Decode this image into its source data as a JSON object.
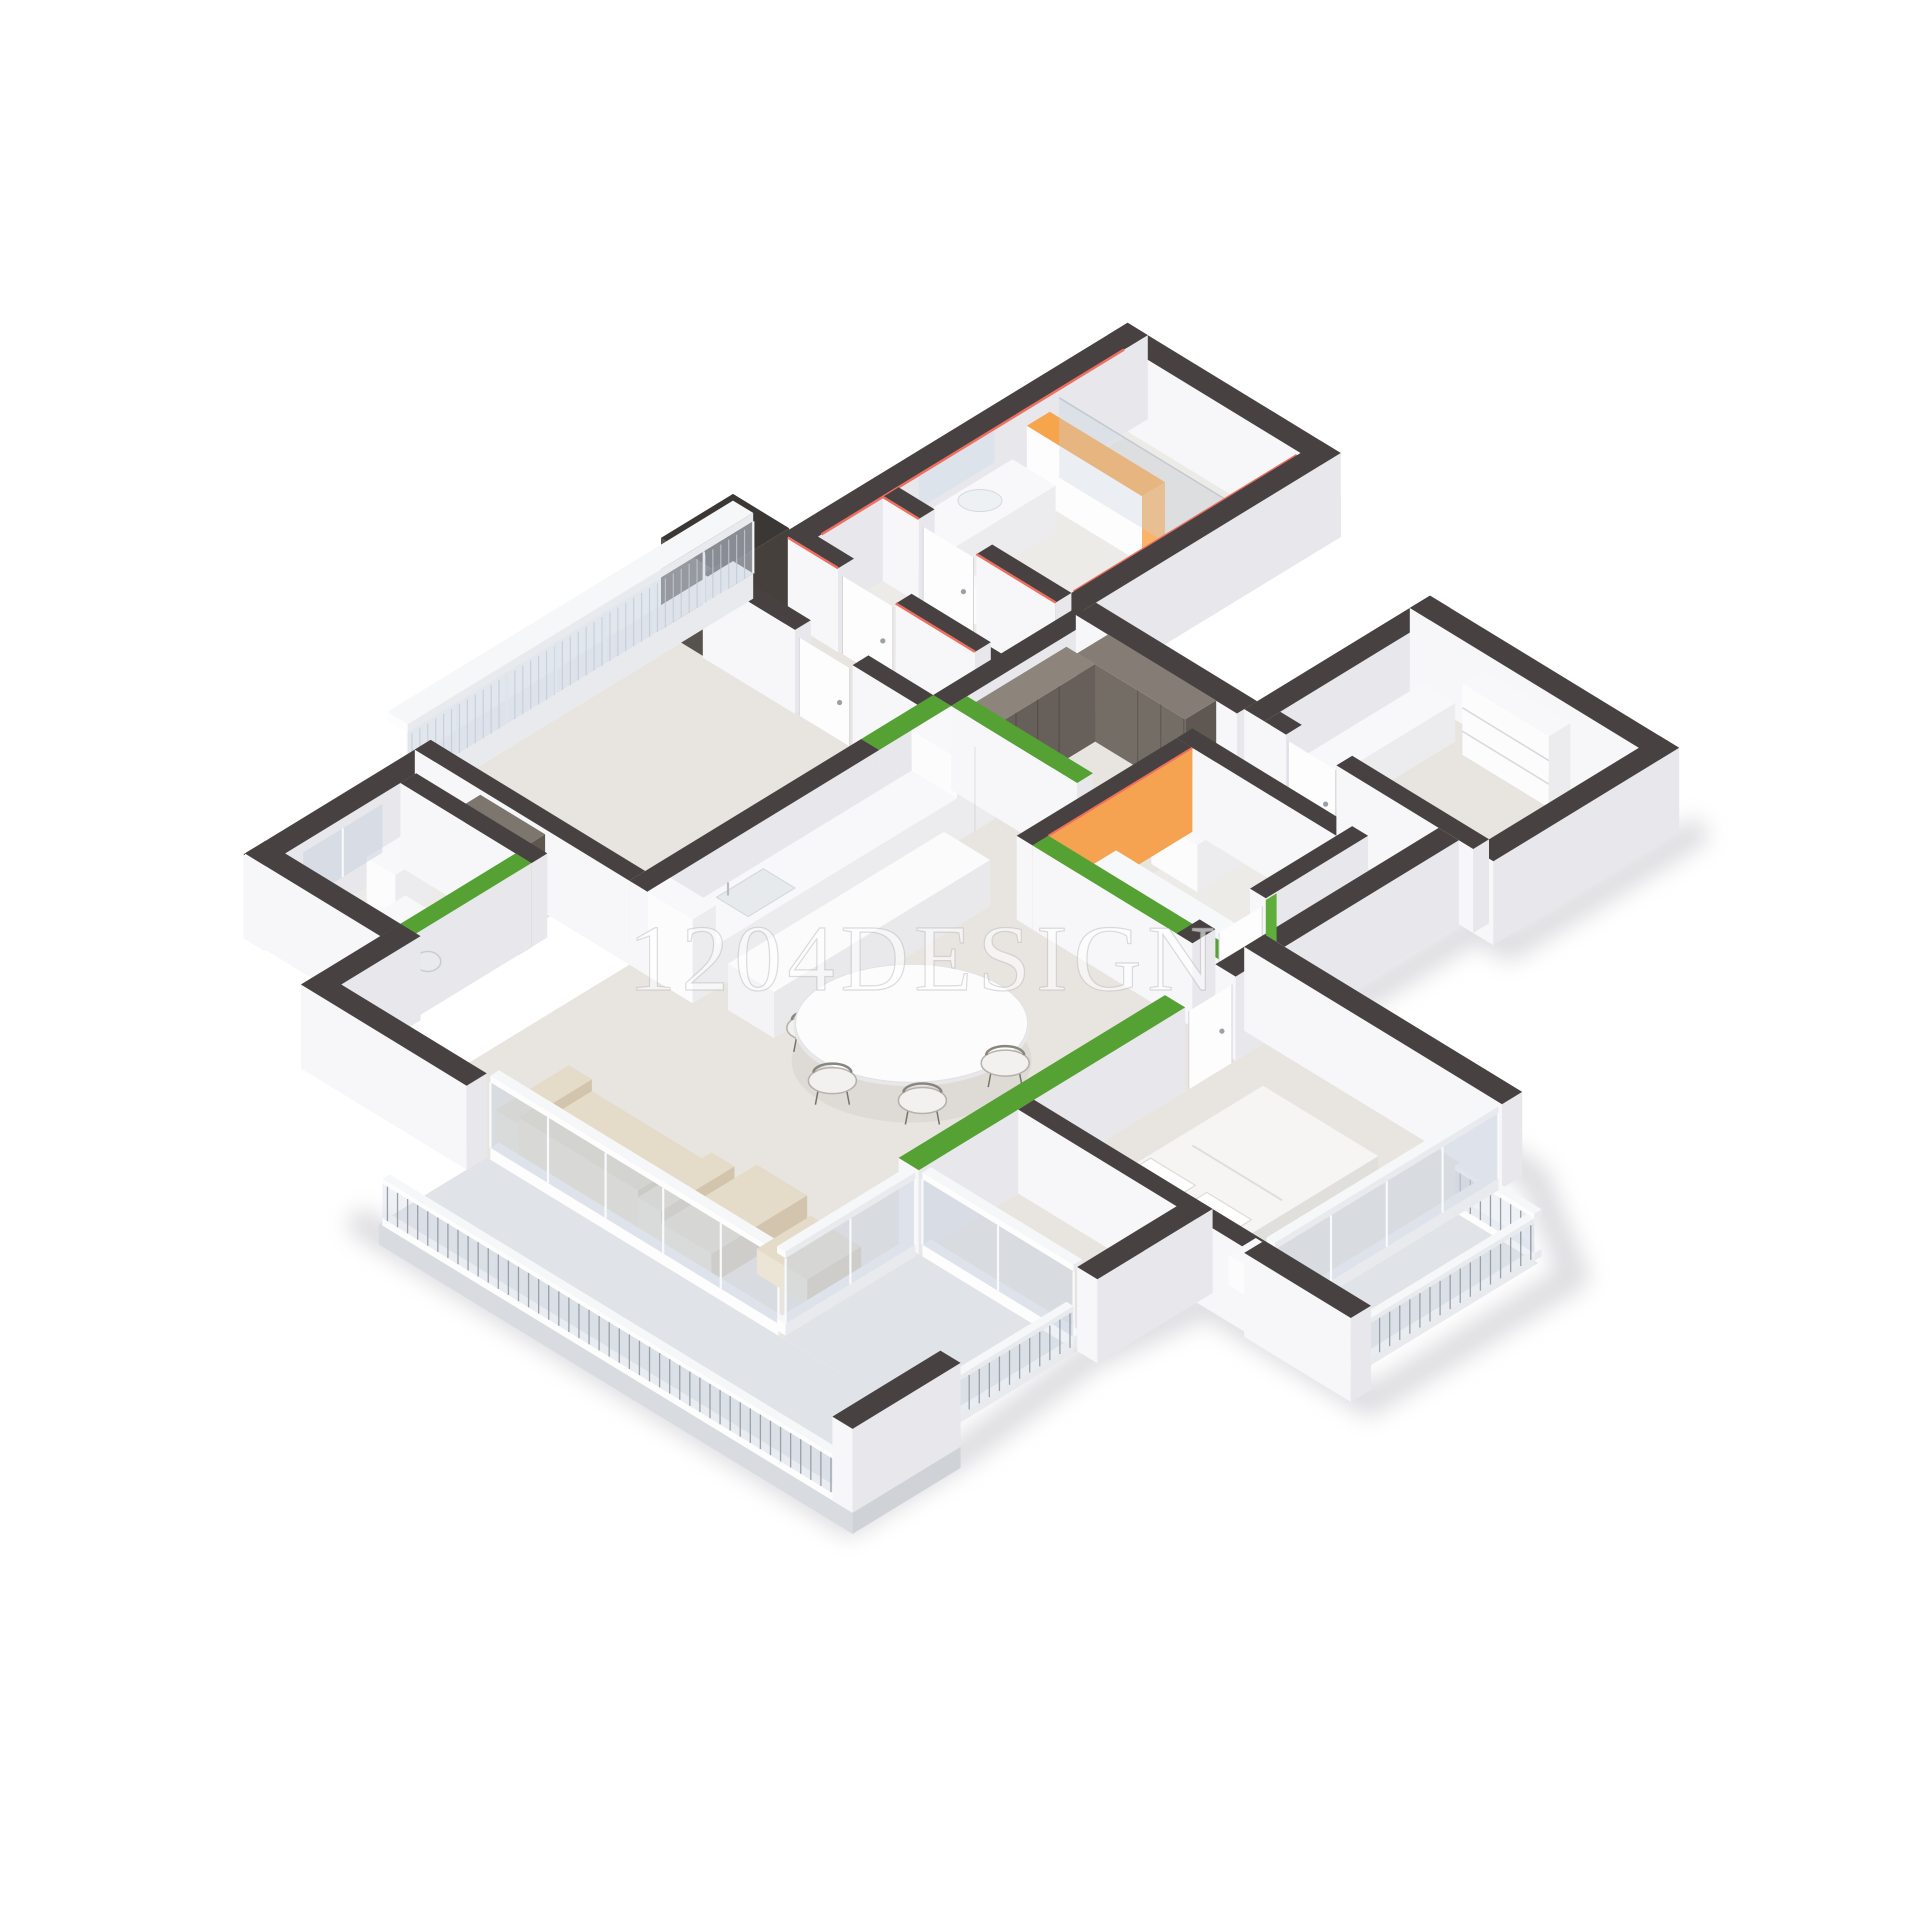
{
  "watermark": {
    "text": "1204DESIGN"
  },
  "scene": {
    "kind": "isometric-3d-floorplan-cutaway"
  },
  "colors": {
    "background": "#ffffff",
    "wall_top": "#474241",
    "wall_top_darker": "#3b3734",
    "wall_face_light": "#f7f7f9",
    "wall_face_shade": "#e7e7ec",
    "accent_green": "#55a133",
    "accent_green_bright": "#5fae3c",
    "accent_orange_top": "#f7a54d",
    "accent_orange_face": "#f9b469",
    "accent_red_strip": "#ee6f5f",
    "floor_main": "#e8e5e1",
    "floor_tile": "#edebe8",
    "floor_balcony": "#e0e3e7",
    "wood_dark": "#6e6761",
    "wood_mid": "#8d857c",
    "sofa_beige": "#e4dbc8",
    "sofa_shade": "#d3c5ad",
    "glass": "rgba(202,212,224,0.55)",
    "cooktop_black": "#1d1d20",
    "bedding_white": "#f6f5f3",
    "shadow_gray": "#a9a9b2",
    "mat_dark": "#474440"
  }
}
